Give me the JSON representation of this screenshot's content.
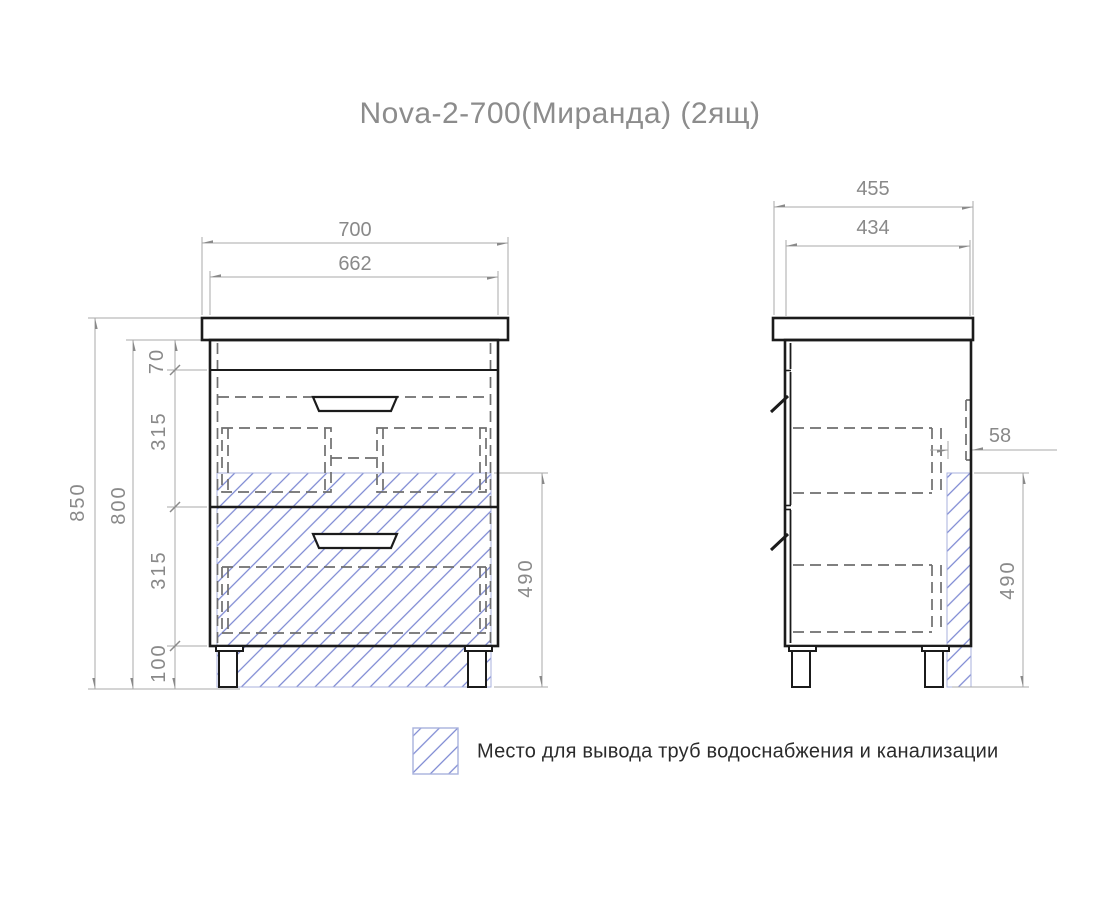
{
  "title": "Nova-2-700(Миранда) (2ящ)",
  "front_view": {
    "width_countertop": "700",
    "width_cabinet": "662",
    "height_total": "850",
    "height_cabinet": "800",
    "seg_top_rail": "70",
    "seg_drawer1": "315",
    "seg_drawer2": "315",
    "seg_legs": "100",
    "pipe_zone_height": "490"
  },
  "side_view": {
    "depth_countertop": "455",
    "depth_cabinet": "434",
    "pipe_zone_depth": "58",
    "pipe_zone_height": "490"
  },
  "legend": {
    "label": "Место для вывода труб водоснабжения и канализации"
  },
  "colors": {
    "outline": "#1b1b1b",
    "dimension_text": "#898989",
    "dimension_line": "#a8a8a8",
    "hidden_line": "#6f6f6f",
    "hatch": "#7b87d2"
  }
}
